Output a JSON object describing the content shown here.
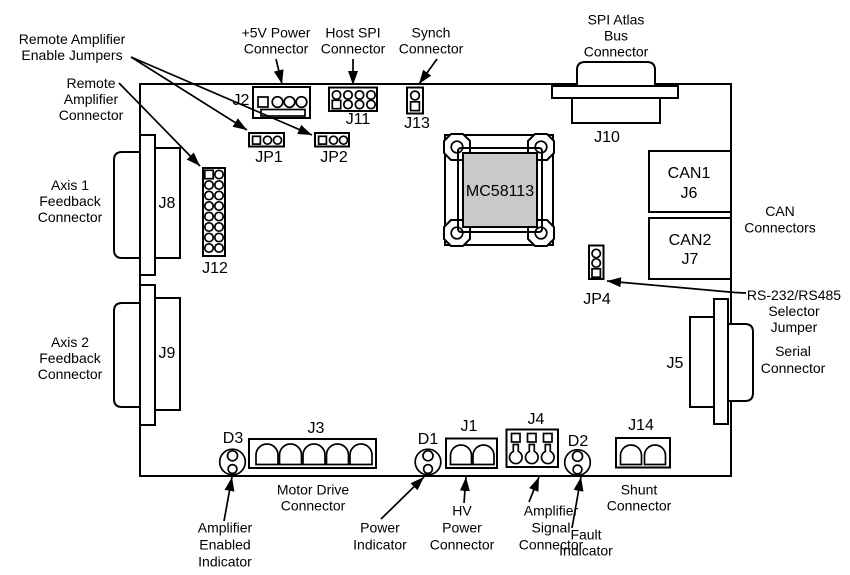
{
  "figure": {
    "background": "#ffffff",
    "line_color": "#000000",
    "chip_fill": "#c9c9c9"
  },
  "chip": {
    "part": "MC58113"
  },
  "refs": {
    "j2": "J2",
    "j11": "J11",
    "j13": "J13",
    "jp1": "JP1",
    "jp2": "JP2",
    "j12": "J12",
    "j8": "J8",
    "j9": "J9",
    "j10": "J10",
    "j5": "J5",
    "can1": "CAN1",
    "j6": "J6",
    "can2": "CAN2",
    "j7": "J7",
    "jp4": "JP4",
    "j3": "J3",
    "j1": "J1",
    "j4": "J4",
    "j14": "J14",
    "d1": "D1",
    "d2": "D2",
    "d3": "D3"
  },
  "callouts": {
    "remote_amplifier_enable_jumpers": [
      "Remote Amplifier",
      "Enable Jumpers"
    ],
    "remote_amplifier_connector": [
      "Remote",
      "Amplifier",
      "Connector"
    ],
    "axis1_feedback_connector": [
      "Axis 1",
      "Feedback",
      "Connector"
    ],
    "axis2_feedback_connector": [
      "Axis 2",
      "Feedback",
      "Connector"
    ],
    "power_5v_connector": [
      "+5V Power",
      "Connector"
    ],
    "host_spi_connector": [
      "Host SPI",
      "Connector"
    ],
    "synch_connector": [
      "Synch",
      "Connector"
    ],
    "spi_atlas_bus_connector": [
      "SPI Atlas",
      "Bus",
      "Connector"
    ],
    "can_connectors": [
      "CAN",
      "Connectors"
    ],
    "rs232_rs485_selector_jumper": [
      "RS-232/RS485",
      "Selector",
      "Jumper"
    ],
    "serial_connector": [
      "Serial",
      "Connector"
    ],
    "motor_drive_connector": [
      "Motor Drive",
      "Connector"
    ],
    "amplifier_enabled_indicator": [
      "Amplifier",
      "Enabled",
      "Indicator"
    ],
    "power_indicator": [
      "Power",
      "Indicator"
    ],
    "hv_power_connector": [
      "HV",
      "Power",
      "Connector"
    ],
    "amplifier_signal_connector": [
      "Amplifier",
      "Signal",
      "Connector"
    ],
    "fault_indicator": [
      "Fault",
      "Indicator"
    ],
    "shunt_connector": [
      "Shunt",
      "Connector"
    ]
  }
}
